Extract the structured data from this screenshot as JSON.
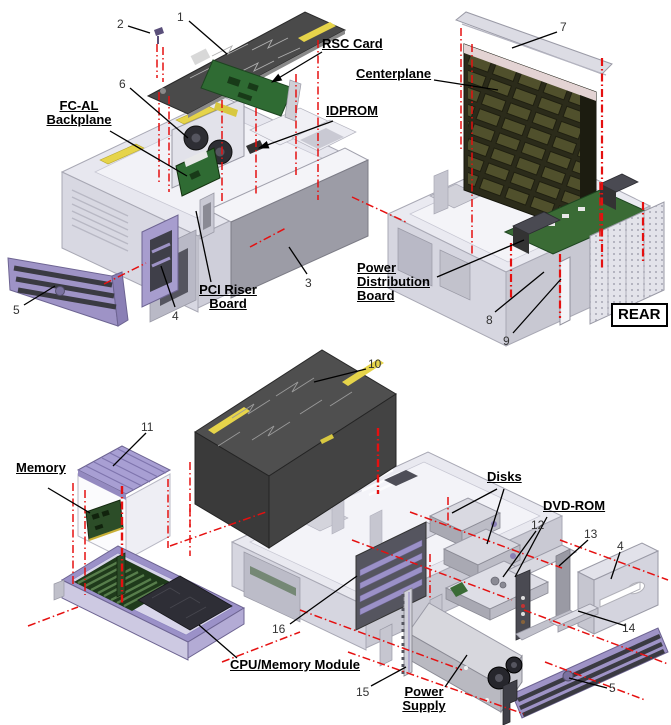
{
  "figure": {
    "type": "exploded-parts-diagram",
    "rear_badge": "REAR"
  },
  "labels": {
    "rsc_card": "RSC Card",
    "centerplane": "Centerplane",
    "idprom": "IDPROM",
    "fcal_1": "FC-AL",
    "fcal_2": "Backplane",
    "pci_1": "PCI Riser",
    "pci_2": "Board",
    "pdb_1": "Power",
    "pdb_2": "Distribution",
    "pdb_3": "Board",
    "memory": "Memory",
    "disks": "Disks",
    "dvd_rom": "DVD-ROM",
    "cpu_memory": "CPU/Memory Module",
    "ps_1": "Power",
    "ps_2": "Supply"
  },
  "callouts": {
    "c1": "1",
    "c2": "2",
    "c3": "3",
    "c4": "4",
    "c5": "5",
    "c6": "6",
    "c7": "7",
    "c8": "8",
    "c9": "9",
    "c10": "10",
    "c11": "11",
    "c12": "12",
    "c13": "13",
    "c14": "14",
    "c15": "15",
    "c16": "16"
  },
  "colors": {
    "explode_line": "#e51010",
    "callout_line": "#000000",
    "chassis": "#e9e9f0",
    "bezel_purple": "#9e93c6",
    "pcb_green": "#34682f",
    "door_dark": "#4a4a4a",
    "accent_yellow": "#e6d44a"
  }
}
